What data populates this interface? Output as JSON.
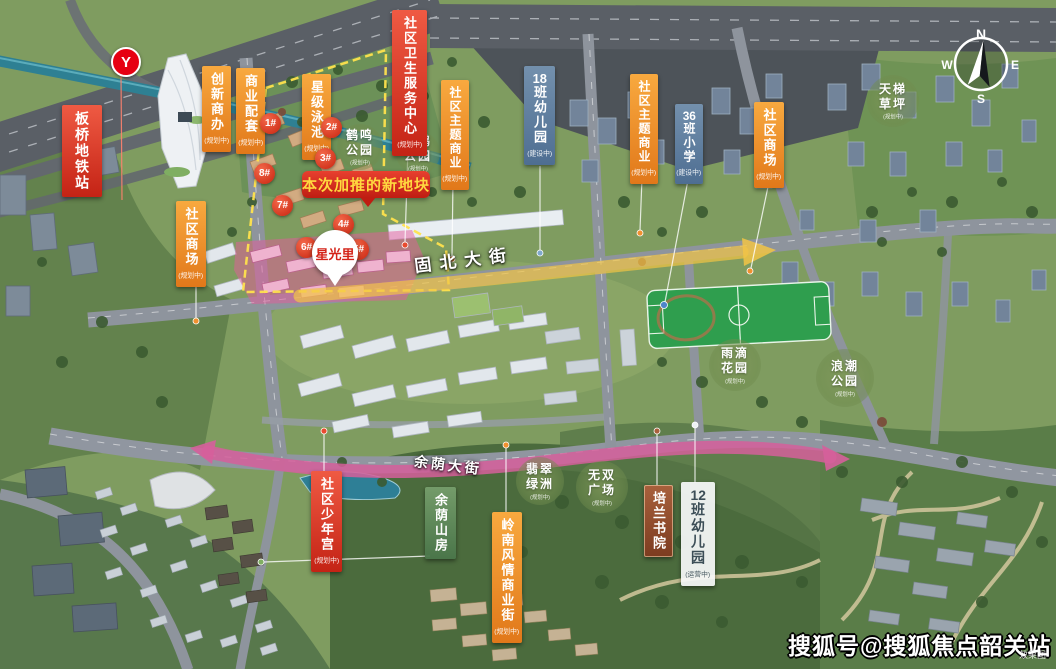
{
  "meta": {
    "watermark": "搜狐号@搜狐焦点韶关站",
    "render_note": "效果图"
  },
  "metro": {
    "logo_glyph": "Y"
  },
  "banner": {
    "text": "本次加推的新地块"
  },
  "pin": {
    "text": "星光里"
  },
  "roads": {
    "gubei": "固北大街",
    "yuyin": "余荫大街"
  },
  "compass": {
    "north": "N",
    "east": "E",
    "south": "S",
    "west": "W"
  },
  "facilities": [
    {
      "text": "板桥地铁站",
      "status": ""
    },
    {
      "text": "创新商办",
      "status": "(规划中)"
    },
    {
      "text": "商业配套",
      "status": "(规划中)"
    },
    {
      "text": "星级泳池",
      "status": "(规划中)"
    },
    {
      "text": "社区卫生服务中心",
      "status": "(规划中)"
    },
    {
      "text": "社区主题商业",
      "status": "(规划中)"
    },
    {
      "text": "18班幼儿园",
      "status": "(建设中)"
    },
    {
      "text": "社区主题商业",
      "status": "(规划中)"
    },
    {
      "text": "36班小学",
      "status": "(建设中)"
    },
    {
      "text": "社区商场",
      "status": "(规划中)"
    },
    {
      "text": "社区商场",
      "status": "(规划中)"
    },
    {
      "text": "社区少年宫",
      "status": "(规划中)"
    },
    {
      "text": "培兰书院",
      "status": ""
    },
    {
      "text": "12班幼儿园",
      "status": "(运营中)"
    },
    {
      "text": "余荫山房",
      "status": ""
    },
    {
      "text": "岭南风情商业街",
      "status": "(规划中)"
    }
  ],
  "parks": [
    {
      "name": "鹤鸣公园",
      "status": "(规划中)"
    },
    {
      "name": "鲲鹏公园",
      "status": "(规划中)"
    },
    {
      "name": "天梯草坪",
      "status": "(规划中)"
    },
    {
      "name": "雨滴花园",
      "status": "(规划中)"
    },
    {
      "name": "浪潮公园",
      "status": "(规划中)"
    },
    {
      "name": "翡翠绿洲",
      "status": "(规划中)"
    },
    {
      "name": "无双广场",
      "status": "(规划中)"
    }
  ],
  "plot_markers": [
    {
      "label": "1#"
    },
    {
      "label": "2#"
    },
    {
      "label": "3#"
    },
    {
      "label": "4#"
    },
    {
      "label": "5#"
    },
    {
      "label": "6#"
    },
    {
      "label": "7#"
    },
    {
      "label": "8#"
    }
  ],
  "colors": {
    "label_red": "#d8352a",
    "label_orange": "#ec8c2a",
    "label_blue": "#5f7d9e",
    "label_maroon": "#93502e",
    "label_green": "#5d8c60",
    "park_green": "#7e9a5c",
    "boundary_yellow": "#ffe14d",
    "route_arrow_yellow": "#f2c445",
    "route_arrow_pink": "#d65f9b",
    "pin_red": "#d42318",
    "metro_red": "#e60012"
  }
}
